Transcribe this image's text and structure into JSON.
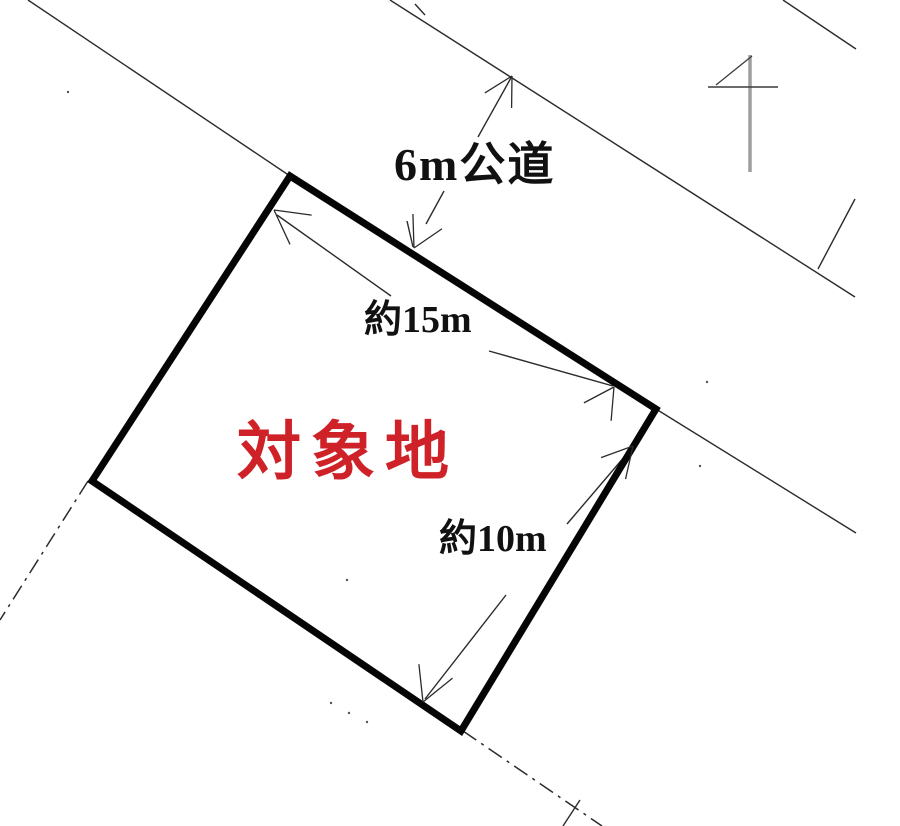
{
  "labels": {
    "road": "6m公道",
    "frontage": "約15m",
    "depth": "約10m",
    "parcel": "対象地"
  },
  "colors": {
    "ink": "#2b2b2b",
    "parcel_outline": "#050505",
    "parcel_label_red": "#cf2128",
    "north_pole_gray": "#9e9e9e",
    "background": "#ffffff"
  },
  "drawing": {
    "canvas": {
      "width": 900,
      "height": 826
    },
    "parcel_polygon": [
      [
        290,
        176
      ],
      [
        656,
        409
      ],
      [
        461,
        731
      ],
      [
        92,
        481
      ]
    ],
    "parcel_stroke_width": 7,
    "thin_lines": [
      [
        28,
        0,
        290,
        176
      ],
      [
        390,
        0,
        855,
        297
      ],
      [
        783,
        0,
        856,
        49
      ],
      [
        818,
        269,
        855,
        199
      ],
      [
        656,
        409,
        856,
        533
      ],
      [
        415,
        4,
        425,
        15
      ],
      [
        580,
        800,
        563,
        826
      ],
      [
        277,
        215,
        391,
        296
      ],
      [
        489,
        351,
        613,
        386
      ],
      [
        631,
        449,
        567,
        524
      ],
      [
        506,
        595,
        425,
        699
      ],
      [
        478,
        137,
        512,
        76
      ],
      [
        426,
        224,
        444,
        191
      ],
      [
        413,
        247,
        407,
        221
      ]
    ],
    "dashdot_lines": [
      [
        88,
        481,
        0,
        620
      ],
      [
        463,
        731,
        602,
        826
      ]
    ],
    "arrows": [
      {
        "tip": [
          274,
          210
        ],
        "dir": [
          -0.8,
          -0.59
        ],
        "len": 38
      },
      {
        "tip": [
          614,
          387
        ],
        "dir": [
          0.55,
          -0.83
        ],
        "len": 34
      },
      {
        "tip": [
          633,
          446
        ],
        "dir": [
          0.66,
          -0.75
        ],
        "len": 34
      },
      {
        "tip": [
          423,
          702
        ],
        "dir": [
          -0.38,
          0.92
        ],
        "len": 38
      },
      {
        "tip": [
          512,
          76
        ],
        "dir": [
          0.49,
          -0.87
        ],
        "len": 32
      },
      {
        "tip": [
          414,
          248
        ],
        "dir": [
          -0.45,
          0.89
        ],
        "len": 34
      }
    ],
    "north_symbol": {
      "pole": [
        750,
        55,
        750,
        172
      ],
      "crossbar": [
        708,
        87,
        778,
        87
      ],
      "diagonal": [
        716,
        85,
        752,
        56
      ]
    },
    "specks": [
      [
        68,
        92
      ],
      [
        347,
        580
      ],
      [
        331,
        703
      ],
      [
        349,
        713
      ],
      [
        367,
        722
      ],
      [
        700,
        466
      ],
      [
        707,
        382
      ]
    ]
  }
}
